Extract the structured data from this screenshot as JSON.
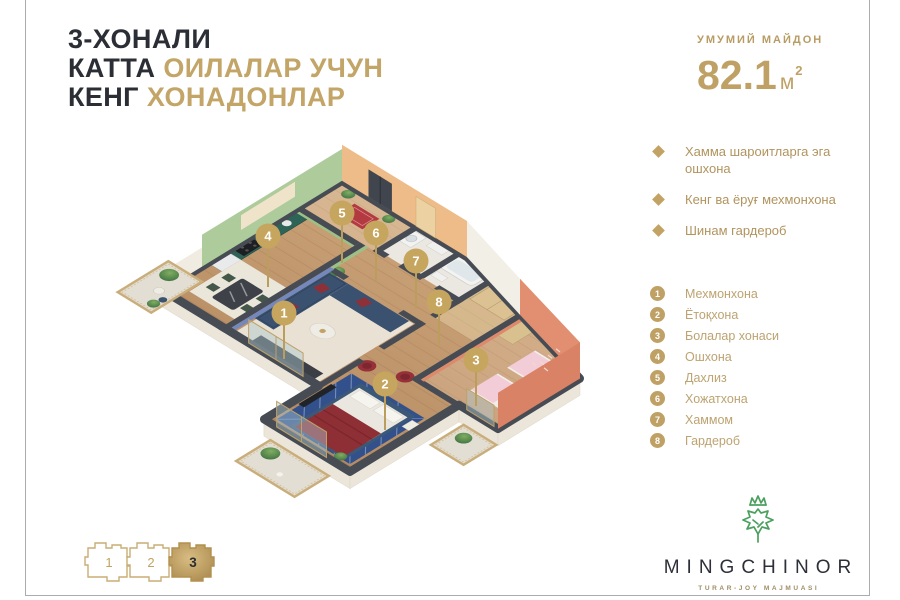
{
  "title": {
    "line1": "3-ХОНАЛИ",
    "line2_dark": "КАТТА",
    "line2_gold": "ОИЛАЛАР УЧУН",
    "line3_dark": "КЕНГ",
    "line3_gold": "ХОНАДОНЛАР"
  },
  "area": {
    "label": "УМУМИЙ МАЙДОН",
    "value": "82.1",
    "unit": "м",
    "sup": "2"
  },
  "features": [
    "Хамма шароитларга эга ошхона",
    "Кенг ва ёруғ мехмонхона",
    "Шинам гардероб"
  ],
  "rooms": [
    {
      "num": "1",
      "label": "Мехмонхона"
    },
    {
      "num": "2",
      "label": "Ётоқхона"
    },
    {
      "num": "3",
      "label": "Болалар хонаси"
    },
    {
      "num": "4",
      "label": "Ошхона"
    },
    {
      "num": "5",
      "label": "Дахлиз"
    },
    {
      "num": "6",
      "label": "Хожатхона"
    },
    {
      "num": "7",
      "label": "Хаммом"
    },
    {
      "num": "8",
      "label": "Гардероб"
    }
  ],
  "floorplan": {
    "markers": [
      "1",
      "2",
      "3",
      "4",
      "5",
      "6",
      "7",
      "8"
    ]
  },
  "selector": {
    "blocks": [
      {
        "label": "1",
        "active": false
      },
      {
        "label": "2",
        "active": false
      },
      {
        "label": "3",
        "active": true
      }
    ]
  },
  "logo": {
    "name": "MINGCHINOR",
    "tagline": "TURAR-JOY MAJMUASI"
  },
  "colors": {
    "gold": "#bfa166",
    "dark_text": "#2b2e35",
    "coral_wall": "#d98166",
    "green_wall": "#a2c78f",
    "blue_wall": "#7488bb",
    "navy_sofa": "#3c5878",
    "red_accent": "#8e2f35",
    "wall_top": "#474c54",
    "logo_green": "#4ba05e"
  }
}
